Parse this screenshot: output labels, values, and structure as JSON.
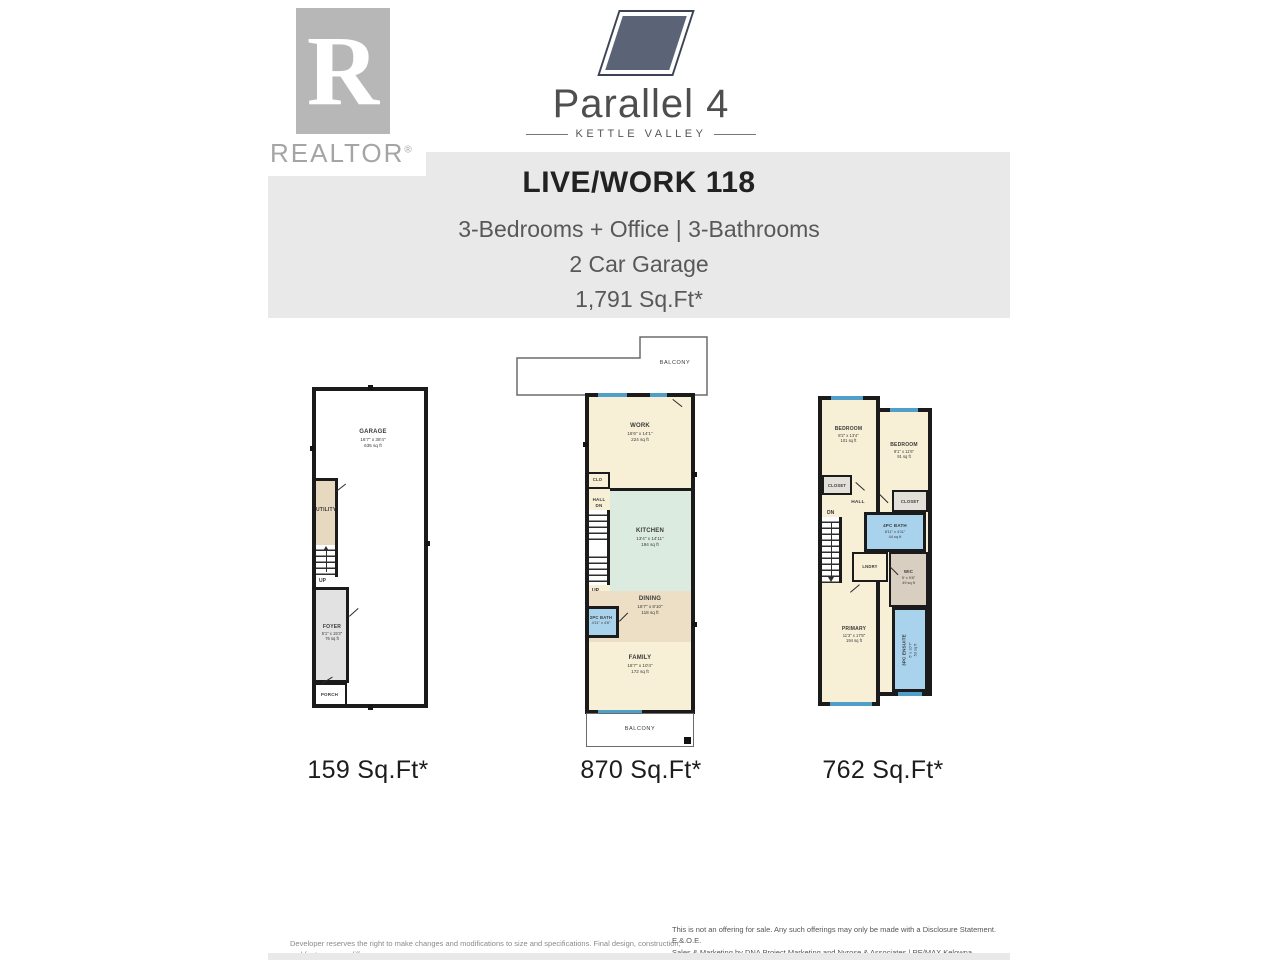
{
  "branding": {
    "realtor_r": "R",
    "realtor_label": "REALTOR",
    "registered": "®",
    "project_name": "Parallel 4",
    "community": "KETTLE VALLEY"
  },
  "header": {
    "title": "LIVE/WORK 118",
    "subtitle1": "3-Bedrooms + Office | 3-Bathrooms",
    "subtitle2": "2 Car Garage",
    "subtitle3": "1,791 Sq.Ft*"
  },
  "plans": [
    {
      "name": "garage-level",
      "footprint_label": "159 Sq.Ft*",
      "rooms": {
        "garage": {
          "name": "GARAGE",
          "dims": "16'7\" x 38'4\"",
          "area": "635 sq ft"
        },
        "utility": {
          "name": "UTILITY"
        },
        "foyer": {
          "name": "FOYER",
          "dims": "5'1\" x 15'3\"",
          "area": "76 sq ft"
        },
        "porch": {
          "name": "PORCH"
        },
        "stairs": {
          "label": "UP"
        }
      }
    },
    {
      "name": "main-level",
      "footprint_label": "870 Sq.Ft*",
      "balcony_top": "BALCONY",
      "balcony_bottom": "BALCONY",
      "rooms": {
        "work": {
          "name": "WORK",
          "dims": "16'6\" x 14'1\"",
          "area": "224 sq ft"
        },
        "clo": {
          "name": "CLO"
        },
        "hall": {
          "name": "HALL",
          "dn": "DN"
        },
        "kitchen": {
          "name": "KITCHEN",
          "dims": "13'4\" x 14'11\"",
          "area": "194 sq ft"
        },
        "dining": {
          "name": "DINING",
          "dims": "16'7\" x 8'10\"",
          "area": "118 sq ft"
        },
        "bath": {
          "name": "2PC BATH",
          "dims": "4'11\" x 4'6\""
        },
        "family": {
          "name": "FAMILY",
          "dims": "16'7\" x 10'4\"",
          "area": "172 sq ft"
        },
        "stairs": {
          "label": "UP"
        }
      }
    },
    {
      "name": "upper-level",
      "footprint_label": "762 Sq.Ft*",
      "rooms": {
        "bedroom_left": {
          "name": "BEDROOM",
          "dims": "8'2\" x 13'4\"",
          "area": "101 sq ft"
        },
        "bedroom_right": {
          "name": "BEDROOM",
          "dims": "8'1\" x 11'6\"",
          "area": "91 sq ft"
        },
        "closet_left": {
          "name": "CLOSET"
        },
        "closet_right": {
          "name": "CLOSET"
        },
        "hall": {
          "name": "HALL",
          "dn": "DN"
        },
        "bath": {
          "name": "4PC BATH",
          "dims": "8'11\" x 4'11\"",
          "area": "44 sq ft"
        },
        "laundry": {
          "name": "LNDRY"
        },
        "wic": {
          "name": "WIC",
          "dims": "5' x 9'8\"",
          "area": "49 sq ft"
        },
        "primary": {
          "name": "PRIMARY",
          "dims": "11'3\" x 17'8\"",
          "area": "194 sq ft"
        },
        "ensuite": {
          "name": "3PC ENSUITE",
          "dims": "5' x 10'7\"",
          "area": "53 sq ft"
        }
      }
    }
  ],
  "footer": {
    "developer_note": "Developer reserves the right to make changes and modifications to size and specifications. Final design, construction, and features may differ.",
    "offering_note_line1": "This is not an offering for sale. Any such offerings may only be made with a Disclosure Statement. E.&.O.E.",
    "offering_note_line2": "Sales & Marketing by DNA Project Marketing and Nyrose & Associates | RE/MAX Kelowna."
  },
  "colors": {
    "wall": "#1b1b1b",
    "room_cream": "#f8efd7",
    "room_mint": "#dcebdf",
    "room_tan": "#ecdfc6",
    "room_blue": "#a9d2ec",
    "room_gray": "#e2e2e2",
    "window": "#4f9fc8",
    "header_bg": "#e9e9e9",
    "logo_mark": "#5b6377"
  }
}
